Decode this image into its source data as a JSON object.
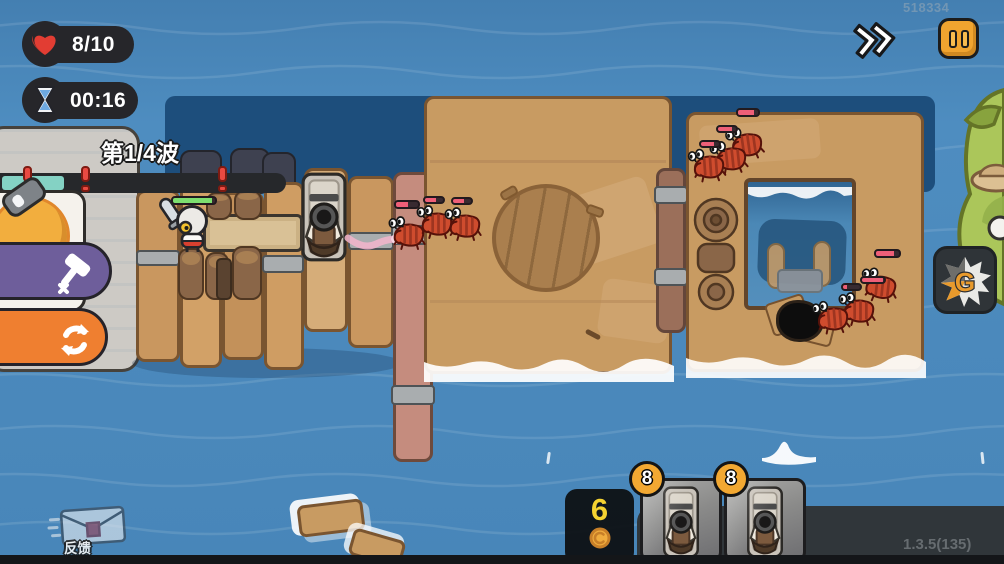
{
  "meta": {
    "app": "raft-defense-game",
    "screen": "battle"
  },
  "hud": {
    "health": {
      "value": "8/10",
      "icon": "heart-icon"
    },
    "timer": {
      "value": "00:16",
      "icon": "hourglass-icon"
    },
    "wave": {
      "label": "第1/4波",
      "progress_percent": 22,
      "marker_count": 3
    },
    "watermark": "518334",
    "controls": {
      "fast_forward_icon": "double-chevron-right",
      "pause_icon": "pause-bars"
    }
  },
  "left_panel": {
    "shop_item": {
      "type": "cannon-portrait"
    },
    "hammer_button": {
      "icon": "hammer-icon"
    },
    "reroll_button": {
      "icon": "refresh-icon"
    }
  },
  "hand": {
    "coin_balance": "6",
    "coin_icon": "coin-icon",
    "cards": [
      {
        "cost": "8",
        "type": "cannon"
      },
      {
        "cost": "8",
        "type": "cannon"
      }
    ]
  },
  "side": {
    "g_button": {
      "label": "G"
    }
  },
  "footer": {
    "version": "1.3.5(135)",
    "feedback_label": "反馈",
    "feedback_icon": "envelope-icon"
  },
  "scene": {
    "hero": "knight",
    "hero_hp_percent": 92,
    "enemy_type": "crab",
    "enemies_visible": 9,
    "turrets_placed": 1
  },
  "colors": {
    "water": "#4e8dc0",
    "raft_wood": "#c9975f",
    "ui_dark": "#26262a",
    "accent_orange": "#f0a42f",
    "hp_green": "#7ddf6f",
    "enemy_hp_pink": "#ee5f78",
    "progress_teal": "#84d2c4",
    "purple_button": "#6e5e9b",
    "orange_button": "#ef7f30"
  }
}
